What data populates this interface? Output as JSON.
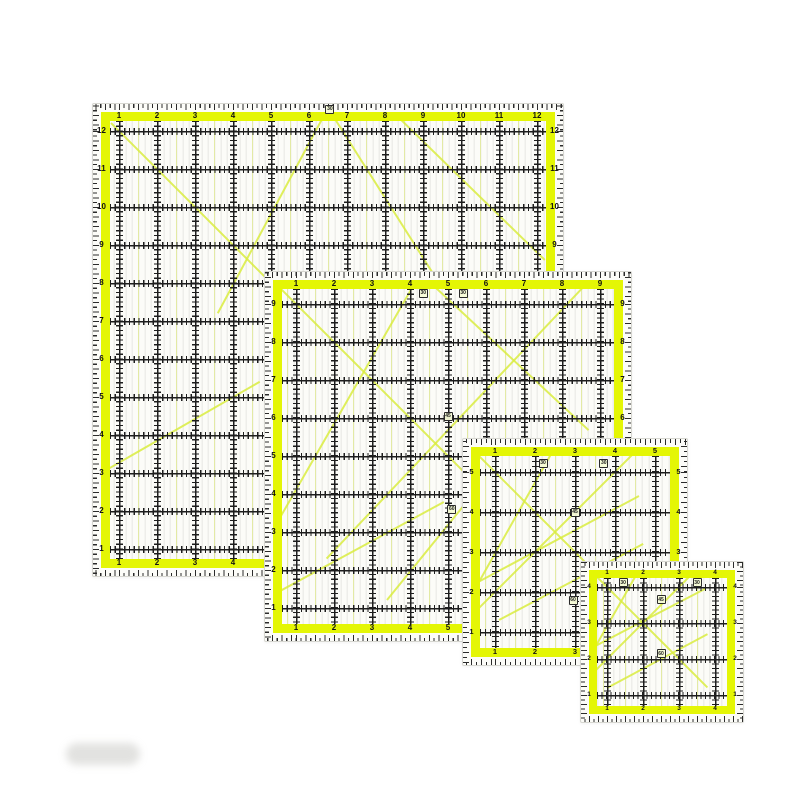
{
  "product": {
    "description": "Set of four square transparent acrylic quilting rulers with fluorescent yellow bands, black inch grids, edge tick scales and 30/45/60 angle guide lines, overlapped from largest (top-left) to smallest (bottom-right) on a white background",
    "background": "#ffffff",
    "colors": {
      "band": "#e4f605",
      "grid": "#1d1d1d",
      "tick": "#2b2b2b",
      "label": "#111111",
      "diagonal": "#d9ec40",
      "interior": "#fcfcf8",
      "edge": "#d6d6d0",
      "stripe": "rgba(70,70,55,0.075)",
      "stripe_yellow": "rgba(222,240,60,0.40)"
    },
    "rulers": [
      {
        "id": "12in",
        "x": 92,
        "y": 103,
        "w": 470,
        "h": 472,
        "margin": 8,
        "band": 9,
        "px": 9,
        "py": 10,
        "s": 38,
        "font": 8,
        "labels": [
          "1",
          "2",
          "3",
          "4",
          "5",
          "6",
          "7",
          "8",
          "9",
          "10",
          "11",
          "12"
        ],
        "angle_markers": [
          {
            "v": "30",
            "u": 5.55,
            "t": -0.62
          }
        ],
        "diagonals": [
          [
            -0.2,
            -0.2,
            6.8,
            6.8
          ],
          [
            5.5,
            -0.6,
            2.6,
            4.8
          ],
          [
            5.5,
            -0.6,
            8.8,
            4.6
          ],
          [
            7.2,
            -0.5,
            11.2,
            3.4
          ],
          [
            -0.3,
            8.9,
            3.7,
            6.6
          ]
        ]
      },
      {
        "id": "9in",
        "x": 264,
        "y": 271,
        "w": 366,
        "h": 369,
        "margin": 8,
        "band": 9,
        "px": 14,
        "py": 15,
        "s": 38,
        "font": 8,
        "labels": [
          "1",
          "2",
          "3",
          "4",
          "5",
          "6",
          "7",
          "8",
          "9"
        ],
        "angle_markers": [
          {
            "v": "30",
            "u": 3.35,
            "t": -0.28
          },
          {
            "v": "30",
            "u": 4.4,
            "t": -0.28
          },
          {
            "v": "45",
            "u": 4.0,
            "t": 2.95
          },
          {
            "v": "60",
            "u": 4.1,
            "t": 5.4
          }
        ],
        "diagonals": [
          [
            -0.7,
            -0.7,
            5.8,
            5.8
          ],
          [
            3.25,
            -0.8,
            -0.6,
            5.9
          ],
          [
            3.3,
            -0.8,
            7.7,
            3.3
          ],
          [
            7.7,
            -0.6,
            0.8,
            6.7
          ],
          [
            -0.7,
            7.7,
            3.9,
            5.2
          ],
          [
            2.4,
            7.8,
            5.0,
            4.6
          ]
        ]
      },
      {
        "id": "6in",
        "x": 462,
        "y": 438,
        "w": 224,
        "h": 226,
        "margin": 8,
        "band": 9,
        "px": 15,
        "py": 16,
        "s": 40,
        "font": 7.5,
        "labels": [
          "1",
          "2",
          "3",
          "4",
          "5"
        ],
        "angle_markers": [
          {
            "v": "30",
            "u": 1.2,
            "t": -0.22
          },
          {
            "v": "30",
            "u": 2.72,
            "t": -0.22
          },
          {
            "v": "45",
            "u": 2.0,
            "t": 1.0
          },
          {
            "v": "60",
            "u": 1.95,
            "t": 3.2
          }
        ],
        "diagonals": [
          [
            -0.7,
            -0.7,
            3.7,
            3.7
          ],
          [
            3.7,
            -0.7,
            -0.7,
            3.7
          ],
          [
            1.6,
            -0.8,
            -0.6,
            3.1
          ],
          [
            -0.7,
            2.9,
            3.6,
            0.6
          ],
          [
            0.1,
            3.7,
            3.7,
            1.8
          ]
        ]
      },
      {
        "id": "4in",
        "x": 580,
        "y": 561,
        "w": 162,
        "h": 160,
        "margin": 8,
        "band": 8,
        "px": 10,
        "py": 9,
        "s": 36,
        "font": 6.5,
        "labels": [
          "1",
          "2",
          "3",
          "4"
        ],
        "angle_markers": [
          {
            "v": "30",
            "u": 0.45,
            "t": -0.12
          },
          {
            "v": "30",
            "u": 2.5,
            "t": -0.12
          },
          {
            "v": "45",
            "u": 1.5,
            "t": 0.35
          },
          {
            "v": "60",
            "u": 1.5,
            "t": 1.85
          }
        ],
        "diagonals": [
          [
            -0.8,
            -0.8,
            2.8,
            2.8
          ],
          [
            2.8,
            -0.8,
            -0.8,
            2.8
          ],
          [
            1.1,
            -0.85,
            -0.75,
            2.4
          ],
          [
            -0.8,
            1.9,
            2.75,
            0.05
          ],
          [
            0.0,
            2.8,
            2.8,
            1.3
          ]
        ]
      }
    ]
  }
}
